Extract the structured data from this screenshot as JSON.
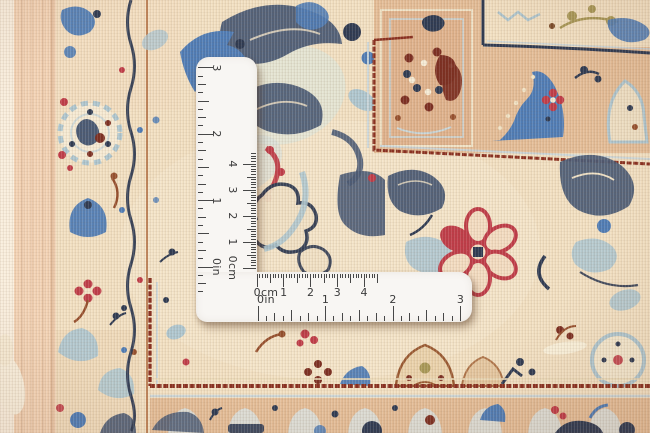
{
  "scene": {
    "description": "Close-up photograph of the corner of a cream handwoven oriental rug with slate-blue arabesque leaves, red rosette flowers, salmon border bands and maroon guard stripes; an L-shaped metal measuring square rests on the pile.",
    "subject": "oriental-rug-with-measuring-square"
  },
  "colors": {
    "rug_cream": "#f2e0c2",
    "rug_peach": "#e4bd97",
    "selvage_pink": "#f3d3b5",
    "navy": "#2e3a52",
    "slate": "#4a5a74",
    "blue": "#4f7cb5",
    "light_blue": "#aec6cf",
    "red": "#bf3c48",
    "maroon": "#7c2f22",
    "maroon_line": "#8a3020",
    "rust": "#96502e",
    "olive": "#a89857",
    "ruler_body": "#f8f6f3",
    "ruler_ink": "#3b3b3b",
    "tick": "#474747"
  },
  "ruler": {
    "shape": "L-square",
    "geometry": {
      "v_arm": {
        "left": 196,
        "top": 57,
        "width": 61,
        "height": 243
      },
      "h_arm": {
        "left": 196,
        "top": 272,
        "width": 276,
        "height": 50
      }
    },
    "scales": [
      {
        "id": "v-in",
        "arm": "vertical",
        "edge": "left",
        "unit": "in",
        "zero": 267,
        "ppu": 66.4,
        "min": -0.45,
        "max": 3.08,
        "divisions": 8,
        "label_offset": 21,
        "labels": [
          {
            "text": "3",
            "u": 3
          },
          {
            "text": "2",
            "u": 2
          },
          {
            "text": "1",
            "u": 1
          },
          {
            "text": "0in",
            "u": 0
          }
        ]
      },
      {
        "id": "v-cm",
        "arm": "vertical",
        "edge": "right",
        "unit": "cm",
        "zero": 268,
        "ppu": 26.0,
        "min": 0,
        "max": 4.42,
        "divisions": 10,
        "label_offset": 24,
        "labels": [
          {
            "text": "4",
            "u": 4
          },
          {
            "text": "3",
            "u": 3
          },
          {
            "text": "2",
            "u": 2
          },
          {
            "text": "1",
            "u": 1
          },
          {
            "text": "0cm",
            "u": 0
          }
        ]
      },
      {
        "id": "h-cm",
        "arm": "horizontal",
        "edge": "top",
        "unit": "cm",
        "zero": 257,
        "ppu": 26.8,
        "min": 0,
        "max": 4.5,
        "divisions": 10,
        "label_offset": 20,
        "labels": [
          {
            "text": "0cm",
            "u": 0,
            "dx": 9
          },
          {
            "text": "1",
            "u": 1
          },
          {
            "text": "2",
            "u": 2
          },
          {
            "text": "3",
            "u": 3
          },
          {
            "text": "4",
            "u": 4
          }
        ]
      },
      {
        "id": "h-in",
        "arm": "horizontal",
        "edge": "bottom",
        "unit": "in",
        "zero": 258,
        "ppu": 67.5,
        "min": 0,
        "max": 3.05,
        "divisions": 8,
        "label_offset": 23,
        "labels": [
          {
            "text": "0in",
            "u": 0,
            "dx": 8
          },
          {
            "text": "1",
            "u": 1
          },
          {
            "text": "2",
            "u": 2
          },
          {
            "text": "3",
            "u": 3
          }
        ]
      }
    ]
  }
}
